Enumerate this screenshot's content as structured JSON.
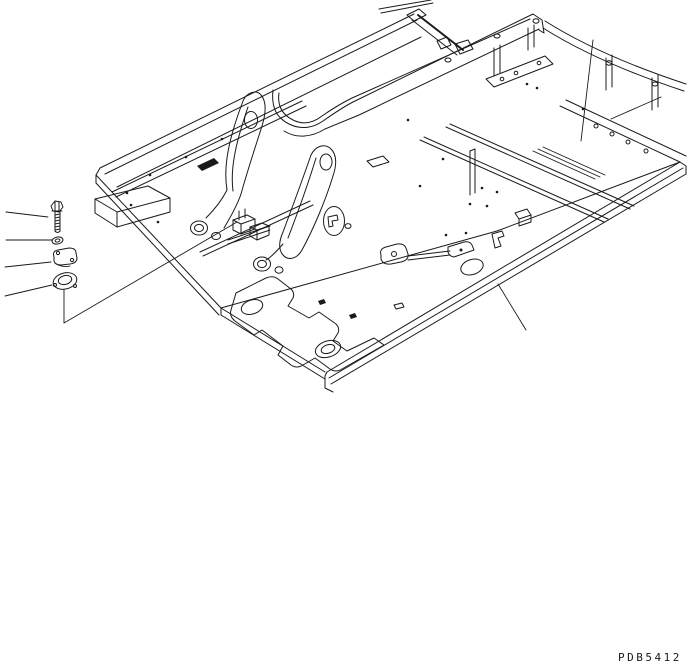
{
  "document": {
    "kind": "technical-parts-diagram",
    "drawing_code": "PDB5412",
    "background_color": "#ffffff",
    "line_color": "#1a1a1a"
  },
  "diagram": {
    "assembly_name": "main-frame-isometric-view",
    "callout_parts": [
      {
        "name": "hex-bolt"
      },
      {
        "name": "washer"
      },
      {
        "name": "cover-plate"
      },
      {
        "name": "seal-ring"
      }
    ],
    "leader_line_count": 8
  }
}
